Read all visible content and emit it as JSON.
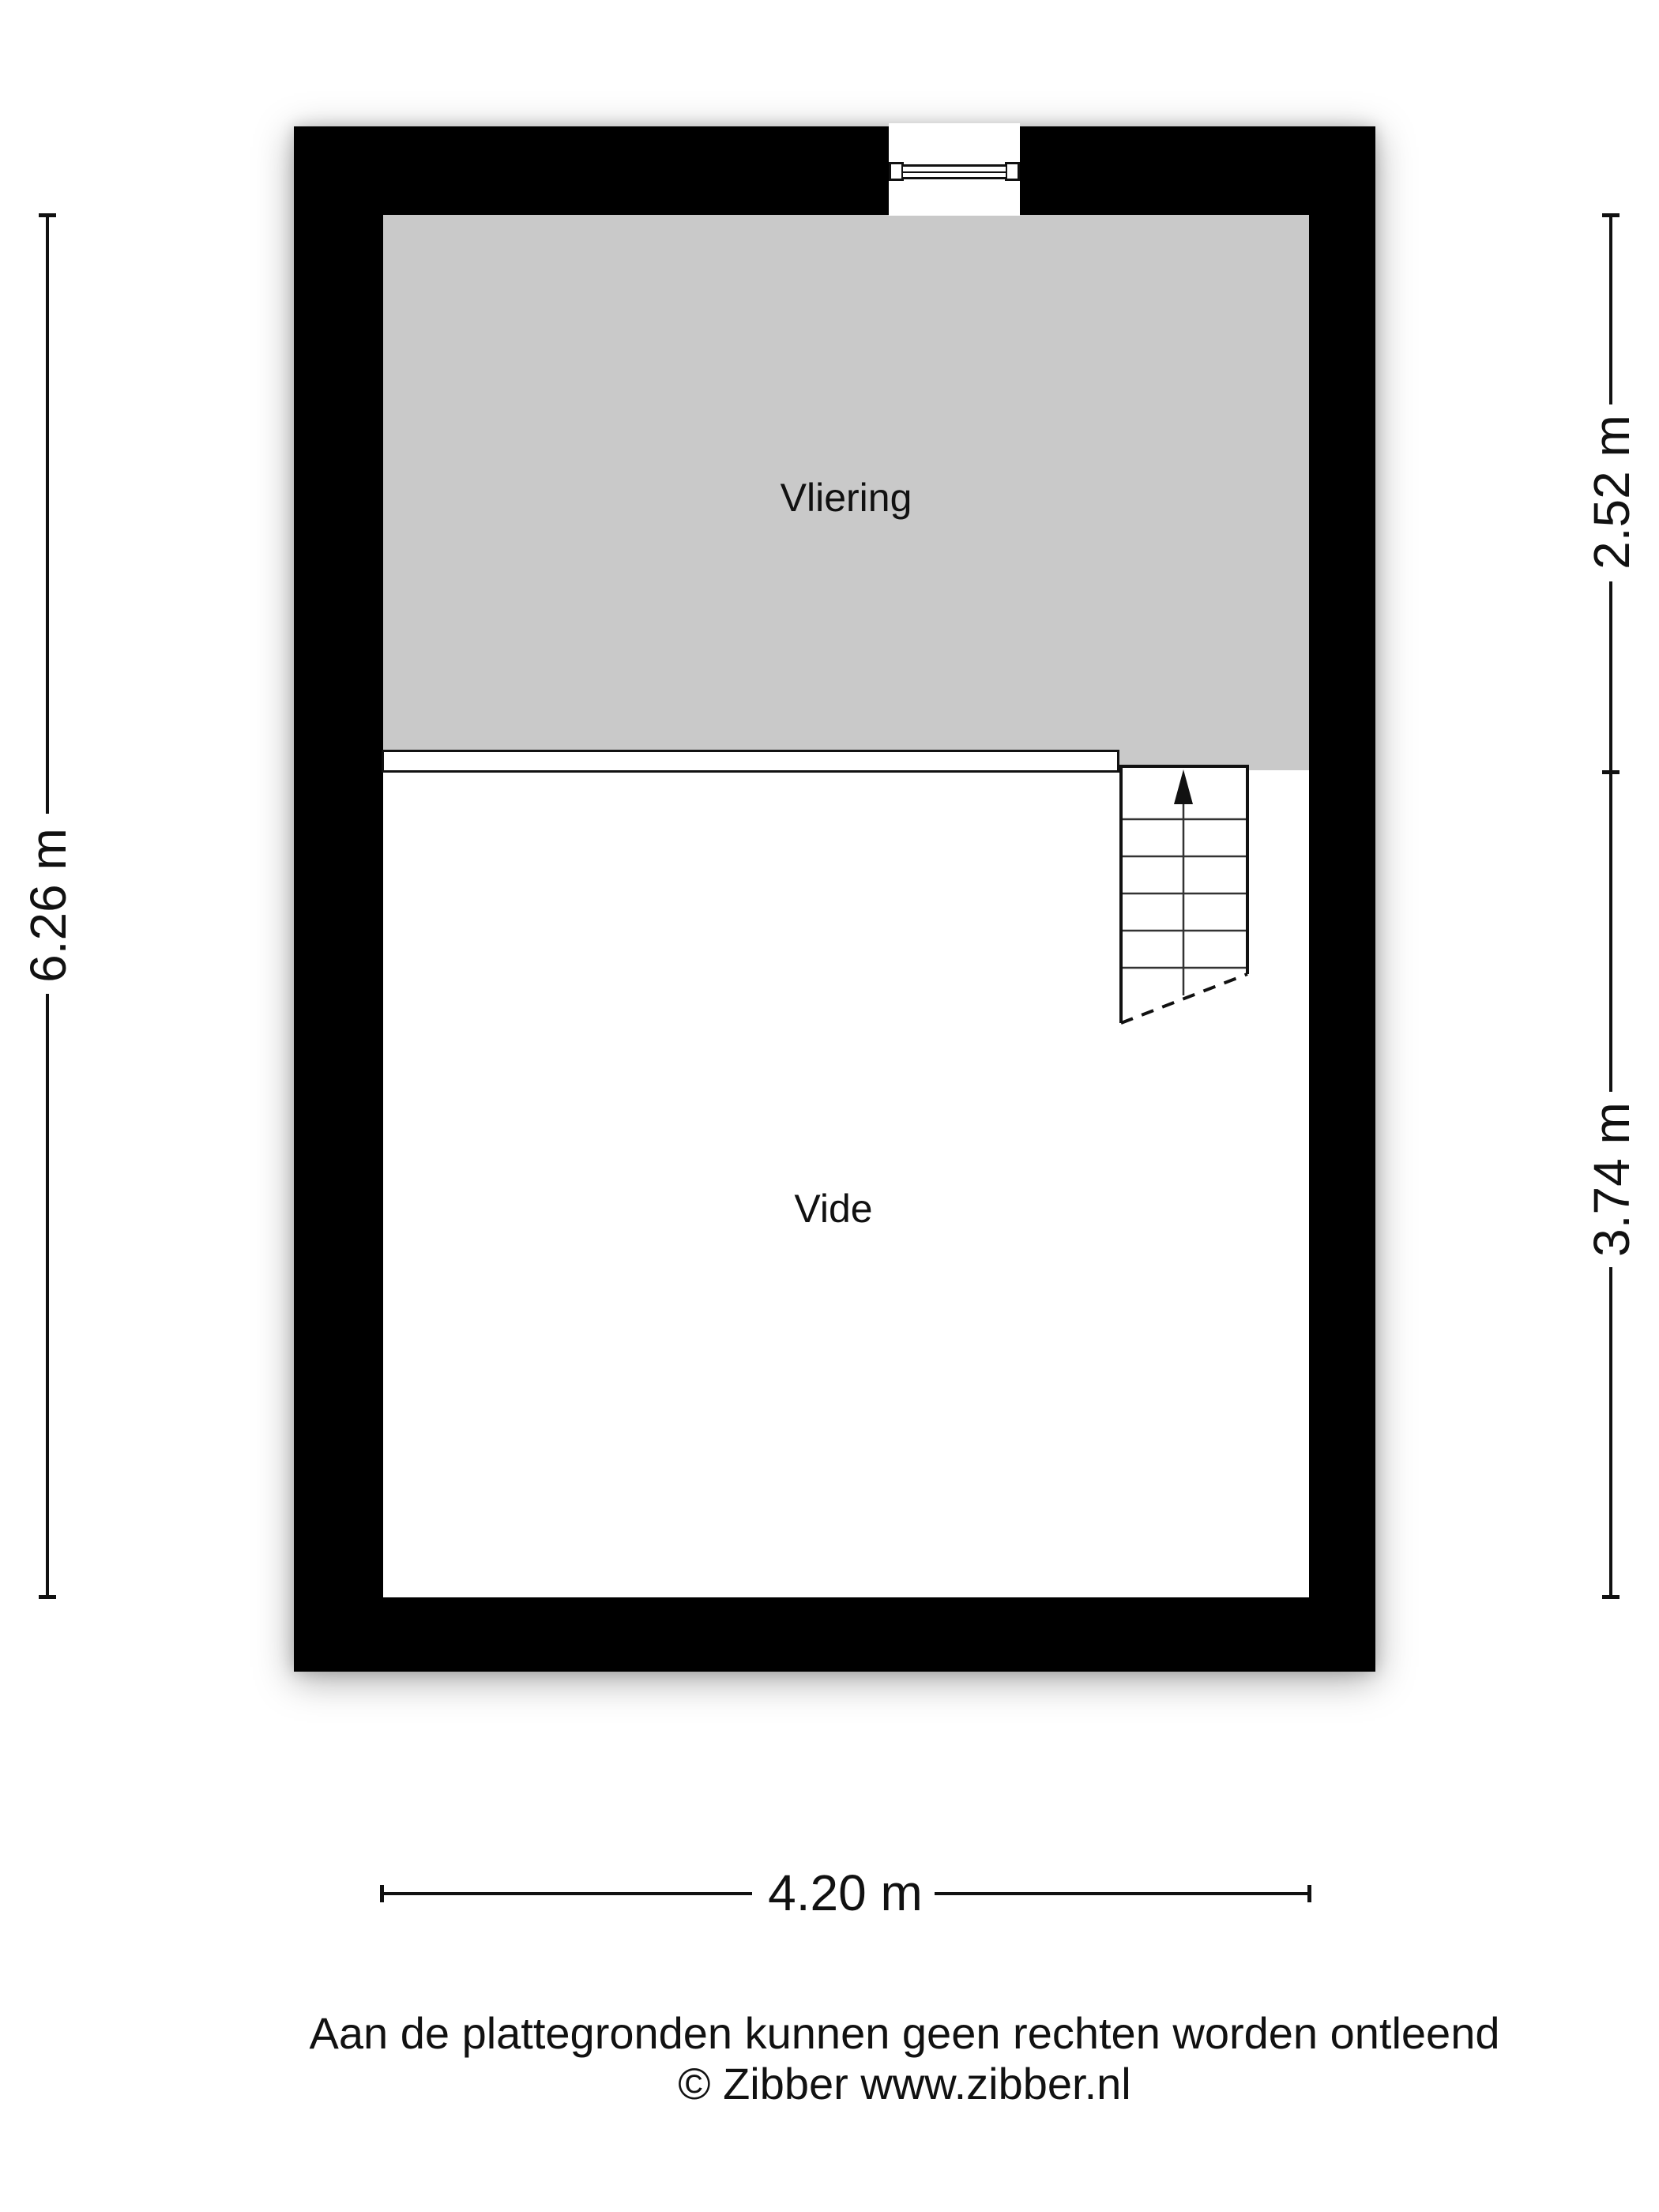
{
  "floorplan": {
    "rooms": {
      "vliering": "Vliering",
      "vide": "Vide"
    },
    "dimensions": {
      "left_total": "6.26 m",
      "right_top": "2.52 m",
      "right_bottom": "3.74 m",
      "bottom": "4.20 m"
    },
    "icons": {
      "window": "window-icon",
      "stairs": "stairs-with-up-arrow-icon"
    },
    "colors": {
      "wall": "#000000",
      "vliering_fill": "#c9c9c9",
      "vide_fill": "#ffffff",
      "line": "#111111"
    }
  },
  "footer": {
    "disclaimer": "Aan de plattegronden kunnen geen rechten worden ontleend",
    "copyright": "© Zibber www.zibber.nl"
  }
}
